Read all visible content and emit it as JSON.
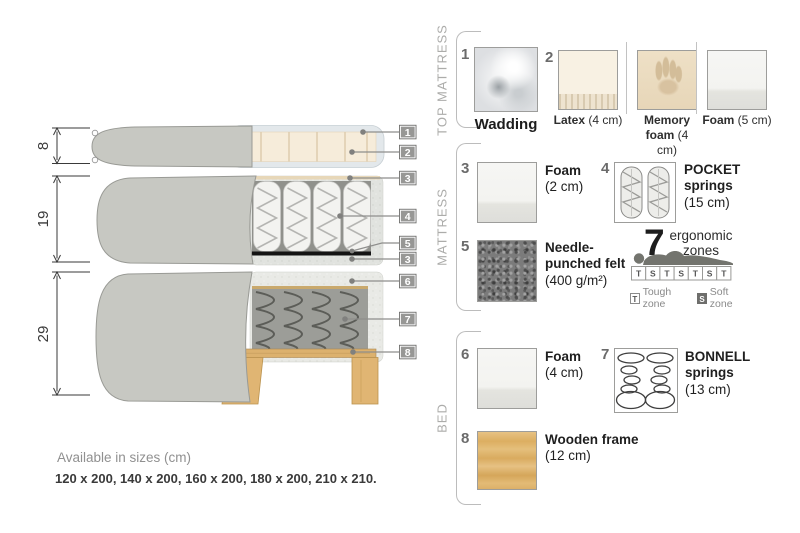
{
  "diagram": {
    "measurements": [
      {
        "value": "8"
      },
      {
        "value": "19"
      },
      {
        "value": "29"
      }
    ],
    "callouts": [
      "1",
      "2",
      "3",
      "4",
      "5",
      "3",
      "6",
      "7",
      "8"
    ]
  },
  "sections": [
    {
      "title": "TOP MATTRESS"
    },
    {
      "title": "MATTRESS"
    },
    {
      "title": "BED"
    }
  ],
  "items": {
    "wadding": {
      "number": "1",
      "name": "Wadding"
    },
    "latex": {
      "number": "2",
      "name": "Latex",
      "size": "(4 cm)"
    },
    "memory_foam": {
      "name": "Memory foam",
      "size": "(4 cm)"
    },
    "foam_top": {
      "name": "Foam",
      "size": "(5 cm)"
    },
    "foam_mattress": {
      "number": "3",
      "name": "Foam",
      "size": "(2 cm)"
    },
    "pocket_springs": {
      "number": "4",
      "name": "POCKET springs",
      "size": "(15 cm)"
    },
    "felt": {
      "number": "5",
      "name": "Needle-punched felt",
      "size": "(400 g/m²)"
    },
    "foam_bed": {
      "number": "6",
      "name": "Foam",
      "size": "(4 cm)"
    },
    "bonnell_springs": {
      "number": "7",
      "name": "BONNELL springs",
      "size": "(13 cm)"
    },
    "wooden_frame": {
      "number": "8",
      "name": "Wooden frame",
      "size": "(12 cm)"
    }
  },
  "ergonomic": {
    "count": "7",
    "label": "ergonomic zones",
    "zones": [
      "T",
      "S",
      "T",
      "S",
      "T",
      "S",
      "T"
    ],
    "legend": [
      {
        "key": "T",
        "label": "Tough zone"
      },
      {
        "key": "S",
        "label": "Soft zone"
      }
    ]
  },
  "footer": {
    "title": "Available in sizes (cm)",
    "sizes": "120 x 200, 140 x 200, 160 x 200, 180 x 200, 210 x 210."
  },
  "colors": {
    "fabric_gray": "#c7c8c2",
    "latex_cream": "#f6ecda",
    "wood": "#ddb271",
    "felt_dark": "#7b7b7b",
    "callout_gray": "#979795"
  }
}
